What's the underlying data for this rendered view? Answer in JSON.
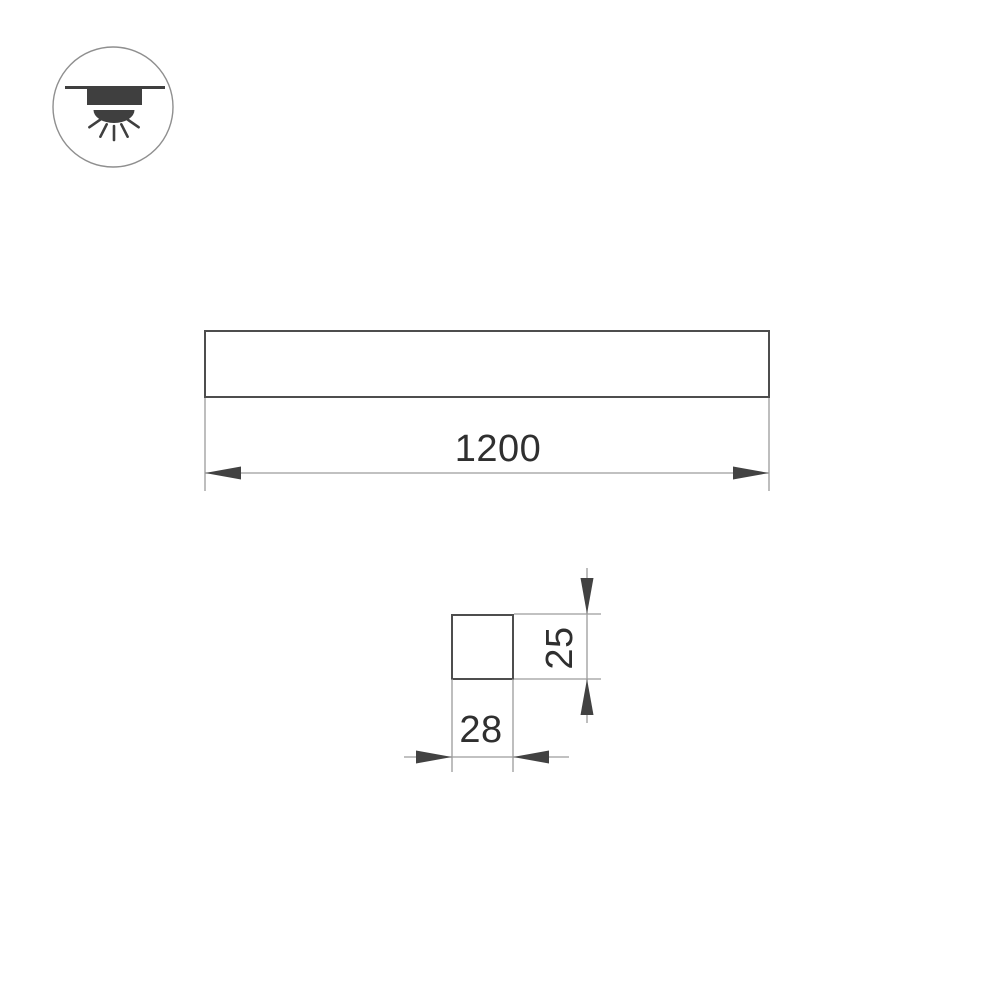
{
  "drawing": {
    "icons": {
      "mount_icon": "surface-ceiling-light-icon"
    },
    "front_view": {
      "length_dim": "1200"
    },
    "section_view": {
      "height_dim": "25",
      "width_dim": "28"
    },
    "colors": {
      "background": "#ffffff",
      "outline_stroke": "#4d4d4d",
      "thin_line": "#9c9c9c",
      "arrowhead": "#424242",
      "text": "#2f2f2f",
      "icon_fill": "#3f3f3f",
      "icon_circle_stroke": "#8f8f8f"
    }
  }
}
